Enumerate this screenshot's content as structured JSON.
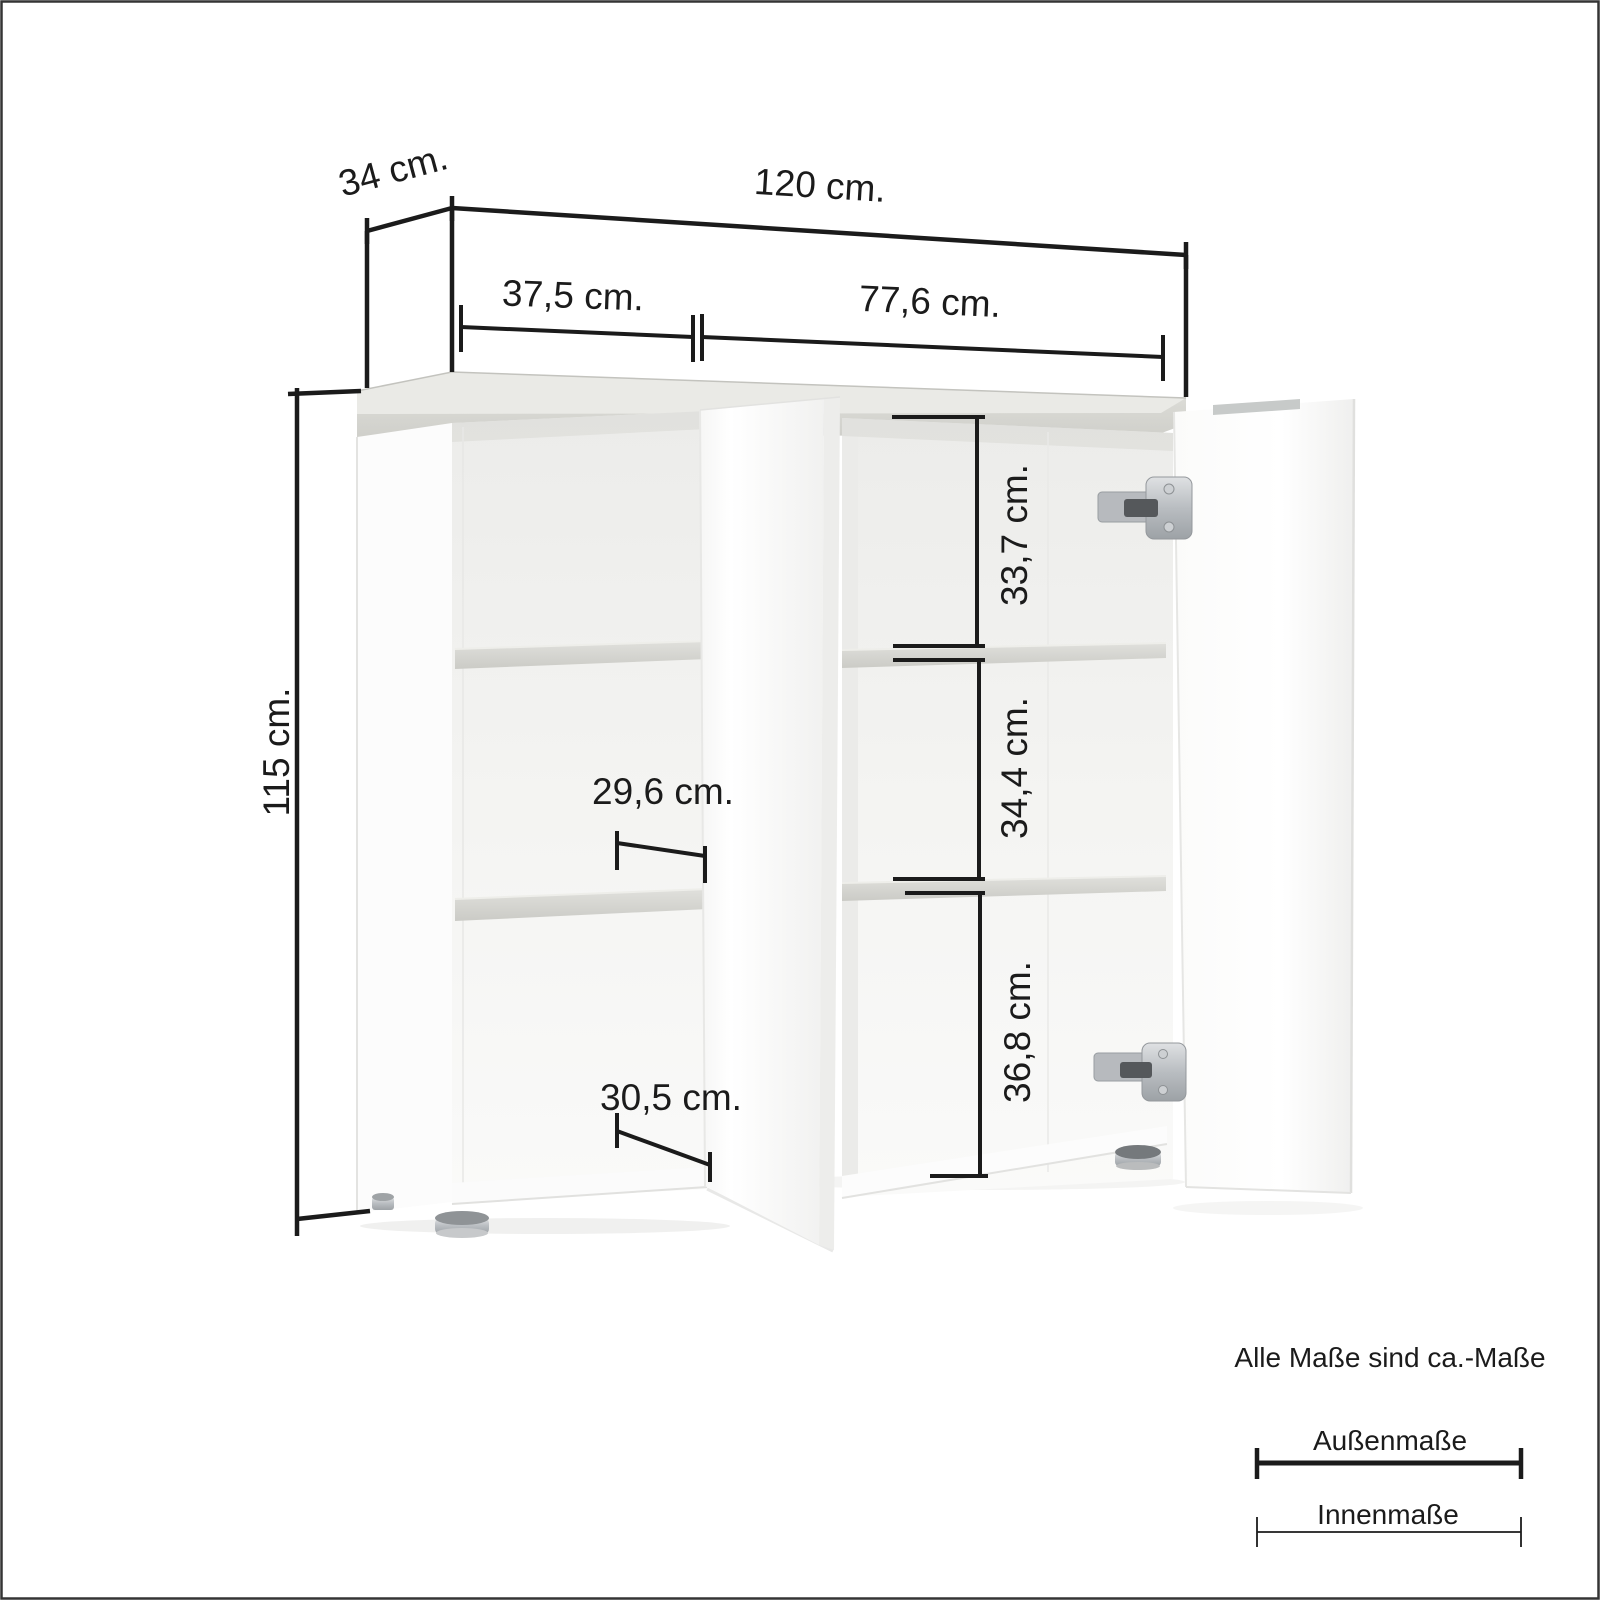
{
  "frame": {
    "background": "#ffffff",
    "border_color": "#343434"
  },
  "dimensions": {
    "depth": "34 cm.",
    "width": "120 cm.",
    "height": "115 cm.",
    "left_section_width": "37,5 cm.",
    "right_section_width": "77,6 cm.",
    "right_top_compartment_height": "33,7 cm.",
    "right_middle_compartment_height": "34,4 cm.",
    "right_bottom_compartment_height": "36,8 cm.",
    "left_middle_compartment_depth": "29,6 cm.",
    "left_bottom_compartment_depth": "30,5 cm."
  },
  "legend": {
    "note": "Alle Maße sind ca.-Maße",
    "outer_measure_label": "Außenmaße",
    "inner_measure_label": "Innenmaße"
  },
  "colors": {
    "dimension_line": "#1b1b1b",
    "wood": "#d9d9d5",
    "cabinet_white": "#fcfcfc"
  }
}
